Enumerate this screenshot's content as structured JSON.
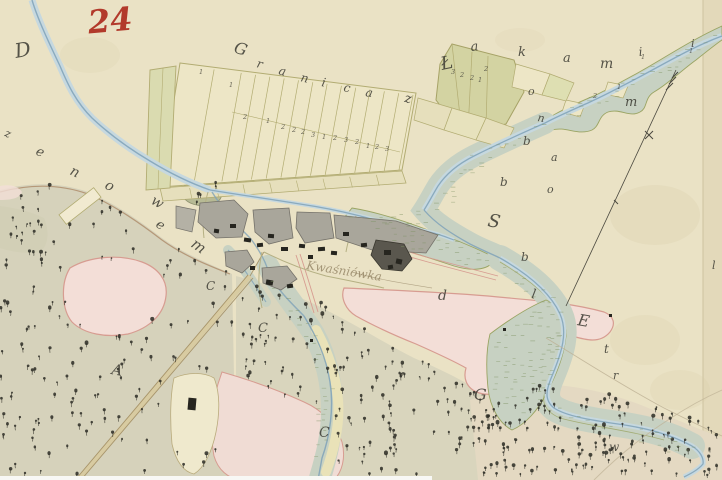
{
  "map": {
    "sheet_number": "24",
    "boundary_label_top": {
      "text": "Granica z Łąkami",
      "letters": [
        {
          "ch": "G",
          "x": 233,
          "y": 52,
          "r": 18,
          "s": 16
        },
        {
          "ch": "r",
          "x": 256,
          "y": 67,
          "r": 15,
          "s": 12
        },
        {
          "ch": "a",
          "x": 278,
          "y": 74,
          "r": 15,
          "s": 12
        },
        {
          "ch": "n",
          "x": 300,
          "y": 81,
          "r": 14,
          "s": 12
        },
        {
          "ch": "i",
          "x": 321,
          "y": 86,
          "r": 12,
          "s": 12
        },
        {
          "ch": "c",
          "x": 343,
          "y": 91,
          "r": 12,
          "s": 12
        },
        {
          "ch": "a",
          "x": 365,
          "y": 96,
          "r": 10,
          "s": 12
        },
        {
          "ch": "z",
          "x": 404,
          "y": 102,
          "r": 10,
          "s": 13
        },
        {
          "ch": "Ł",
          "x": 442,
          "y": 70,
          "r": -12,
          "s": 18
        },
        {
          "ch": "a",
          "x": 471,
          "y": 51,
          "r": -6,
          "s": 13
        },
        {
          "ch": "k",
          "x": 518,
          "y": 56,
          "r": 0,
          "s": 13
        },
        {
          "ch": "a",
          "x": 563,
          "y": 62,
          "r": 0,
          "s": 13
        },
        {
          "ch": "m",
          "x": 600,
          "y": 68,
          "r": 0,
          "s": 14
        },
        {
          "ch": "i",
          "x": 639,
          "y": 56,
          "r": -5,
          "s": 12
        },
        {
          "ch": "m",
          "x": 625,
          "y": 106,
          "r": 0,
          "s": 13
        },
        {
          "ch": "i",
          "x": 691,
          "y": 47,
          "r": 0,
          "s": 11
        }
      ]
    },
    "boundary_label_left": {
      "text": "enowem",
      "letters": [
        {
          "ch": "z",
          "x": 4,
          "y": 136,
          "r": 20,
          "s": 11
        },
        {
          "ch": "D",
          "x": 16,
          "y": 58,
          "r": -10,
          "s": 20
        },
        {
          "ch": "e",
          "x": 35,
          "y": 154,
          "r": 25,
          "s": 13
        },
        {
          "ch": "n",
          "x": 69,
          "y": 174,
          "r": 25,
          "s": 14
        },
        {
          "ch": "o",
          "x": 104,
          "y": 188,
          "r": 25,
          "s": 14
        },
        {
          "ch": "w",
          "x": 150,
          "y": 203,
          "r": 30,
          "s": 14
        },
        {
          "ch": "e",
          "x": 155,
          "y": 226,
          "r": 35,
          "s": 13
        },
        {
          "ch": "m",
          "x": 190,
          "y": 246,
          "r": 35,
          "s": 15
        }
      ]
    },
    "boundary_label_right": {
      "letters": [
        {
          "ch": "o",
          "x": 528,
          "y": 95,
          "r": 0,
          "s": 11
        },
        {
          "ch": "n",
          "x": 537,
          "y": 121,
          "r": 10,
          "s": 11
        },
        {
          "ch": "b",
          "x": 523,
          "y": 145,
          "r": 0,
          "s": 12
        },
        {
          "ch": "a",
          "x": 551,
          "y": 161,
          "r": 0,
          "s": 11
        },
        {
          "ch": "o",
          "x": 547,
          "y": 193,
          "r": 0,
          "s": 11
        },
        {
          "ch": "b",
          "x": 500,
          "y": 186,
          "r": 0,
          "s": 12
        },
        {
          "ch": "S",
          "x": 487,
          "y": 226,
          "r": 10,
          "s": 18
        },
        {
          "ch": "b",
          "x": 521,
          "y": 261,
          "r": 0,
          "s": 12
        },
        {
          "ch": "l",
          "x": 531,
          "y": 298,
          "r": 10,
          "s": 13
        },
        {
          "ch": "E",
          "x": 577,
          "y": 325,
          "r": 10,
          "s": 16
        },
        {
          "ch": "t",
          "x": 604,
          "y": 353,
          "r": 0,
          "s": 12
        },
        {
          "ch": "r",
          "x": 613,
          "y": 379,
          "r": 0,
          "s": 11
        },
        {
          "ch": "w",
          "x": 609,
          "y": 451,
          "r": 0,
          "s": 12
        }
      ]
    },
    "village_label": {
      "text": "Kwaśniówka"
    },
    "parcel_letters": [
      {
        "ch": "d",
        "x": 438,
        "y": 300,
        "r": 0,
        "s": 14
      },
      {
        "ch": "G",
        "x": 474,
        "y": 400,
        "r": 0,
        "s": 16
      },
      {
        "ch": "C",
        "x": 319,
        "y": 437,
        "r": 0,
        "s": 14
      },
      {
        "ch": "C",
        "x": 258,
        "y": 332,
        "r": 0,
        "s": 13
      },
      {
        "ch": "A",
        "x": 111,
        "y": 374,
        "r": 10,
        "s": 15
      },
      {
        "ch": "C",
        "x": 206,
        "y": 290,
        "r": 0,
        "s": 12
      },
      {
        "ch": "l",
        "x": 712,
        "y": 269,
        "r": 0,
        "s": 11
      }
    ],
    "strip_numbers": [
      {
        "n": "1",
        "x": 199,
        "y": 74
      },
      {
        "n": "1",
        "x": 229,
        "y": 87
      },
      {
        "n": "2",
        "x": 243,
        "y": 119
      },
      {
        "n": "1",
        "x": 266,
        "y": 123
      },
      {
        "n": "2",
        "x": 281,
        "y": 129
      },
      {
        "n": "2",
        "x": 292,
        "y": 132
      },
      {
        "n": "2",
        "x": 301,
        "y": 134
      },
      {
        "n": "3",
        "x": 311,
        "y": 137
      },
      {
        "n": "1",
        "x": 322,
        "y": 139
      },
      {
        "n": "2",
        "x": 333,
        "y": 140
      },
      {
        "n": "3",
        "x": 344,
        "y": 142
      },
      {
        "n": "2",
        "x": 355,
        "y": 144
      },
      {
        "n": "1",
        "x": 366,
        "y": 148
      },
      {
        "n": "2",
        "x": 375,
        "y": 149
      },
      {
        "n": "3",
        "x": 385,
        "y": 151
      }
    ],
    "small_numbers": [
      {
        "n": "3",
        "x": 451,
        "y": 74
      },
      {
        "n": "2",
        "x": 460,
        "y": 77
      },
      {
        "n": "2",
        "x": 470,
        "y": 80
      },
      {
        "n": "1",
        "x": 478,
        "y": 82
      },
      {
        "n": "2",
        "x": 484,
        "y": 71
      },
      {
        "n": "2",
        "x": 593,
        "y": 98
      },
      {
        "n": "1",
        "x": 689,
        "y": 53
      },
      {
        "n": "1",
        "x": 641,
        "y": 59
      },
      {
        "n": "1",
        "x": 617,
        "y": 89
      }
    ],
    "colors": {
      "paper": "#eae2c5",
      "paper_edge": "#e2d8b8",
      "cream": "#efe9cd",
      "river": "#7fa2b8",
      "river_wash": "#c6d8df",
      "meadow": "#c7d1c2",
      "meadow_line": "#9aa463",
      "strip_fill": "#ede6c6",
      "strip_fill2": "#e6dfbc",
      "strip_line": "#b2ac72",
      "green_block": "#d3d3a2",
      "forest": "#d6d2bb",
      "forest2": "#d9d5bd",
      "forest3": "#e4d9c2",
      "forest_edge": "#ad8a68",
      "pink": "#f3ded7",
      "pink_edge": "#d79c91",
      "gray_yard": "#a9a69b",
      "yard_edge": "#75726a",
      "building": "#26251f",
      "road": "#d8cba1",
      "road_edge": "#a7946a",
      "ink": "#3b3a32",
      "ink_faint": "#8d7d5d",
      "red": "#b23a2b",
      "pencil": "#bdb094"
    }
  }
}
